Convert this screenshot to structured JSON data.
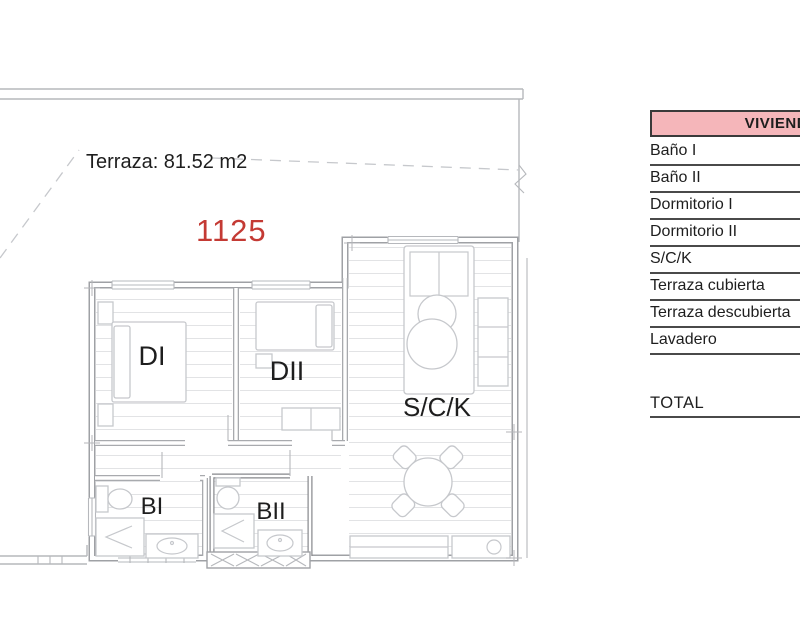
{
  "colors": {
    "accent-red": "#c43a34",
    "header-pink": "#f5b6ba",
    "ink": "#1e1e1e",
    "wall": "#9fa1a5",
    "line": "#b6b8bc"
  },
  "plan": {
    "terrace_label": "Terraza: 81.52 m2",
    "unit_number": "1125",
    "rooms": {
      "dormitorio1": "DI",
      "dormitorio2": "DII",
      "salon_cocina": "S/C/K",
      "bano1": "BI",
      "bano2": "BII"
    }
  },
  "table": {
    "header": "VIVIENDA",
    "rows": [
      "Baño I",
      "Baño II",
      "Dormitorio I",
      "Dormitorio II",
      "S/C/K",
      "Terraza cubierta",
      "Terraza descubierta",
      "Lavadero"
    ],
    "total_label": "TOTAL"
  }
}
